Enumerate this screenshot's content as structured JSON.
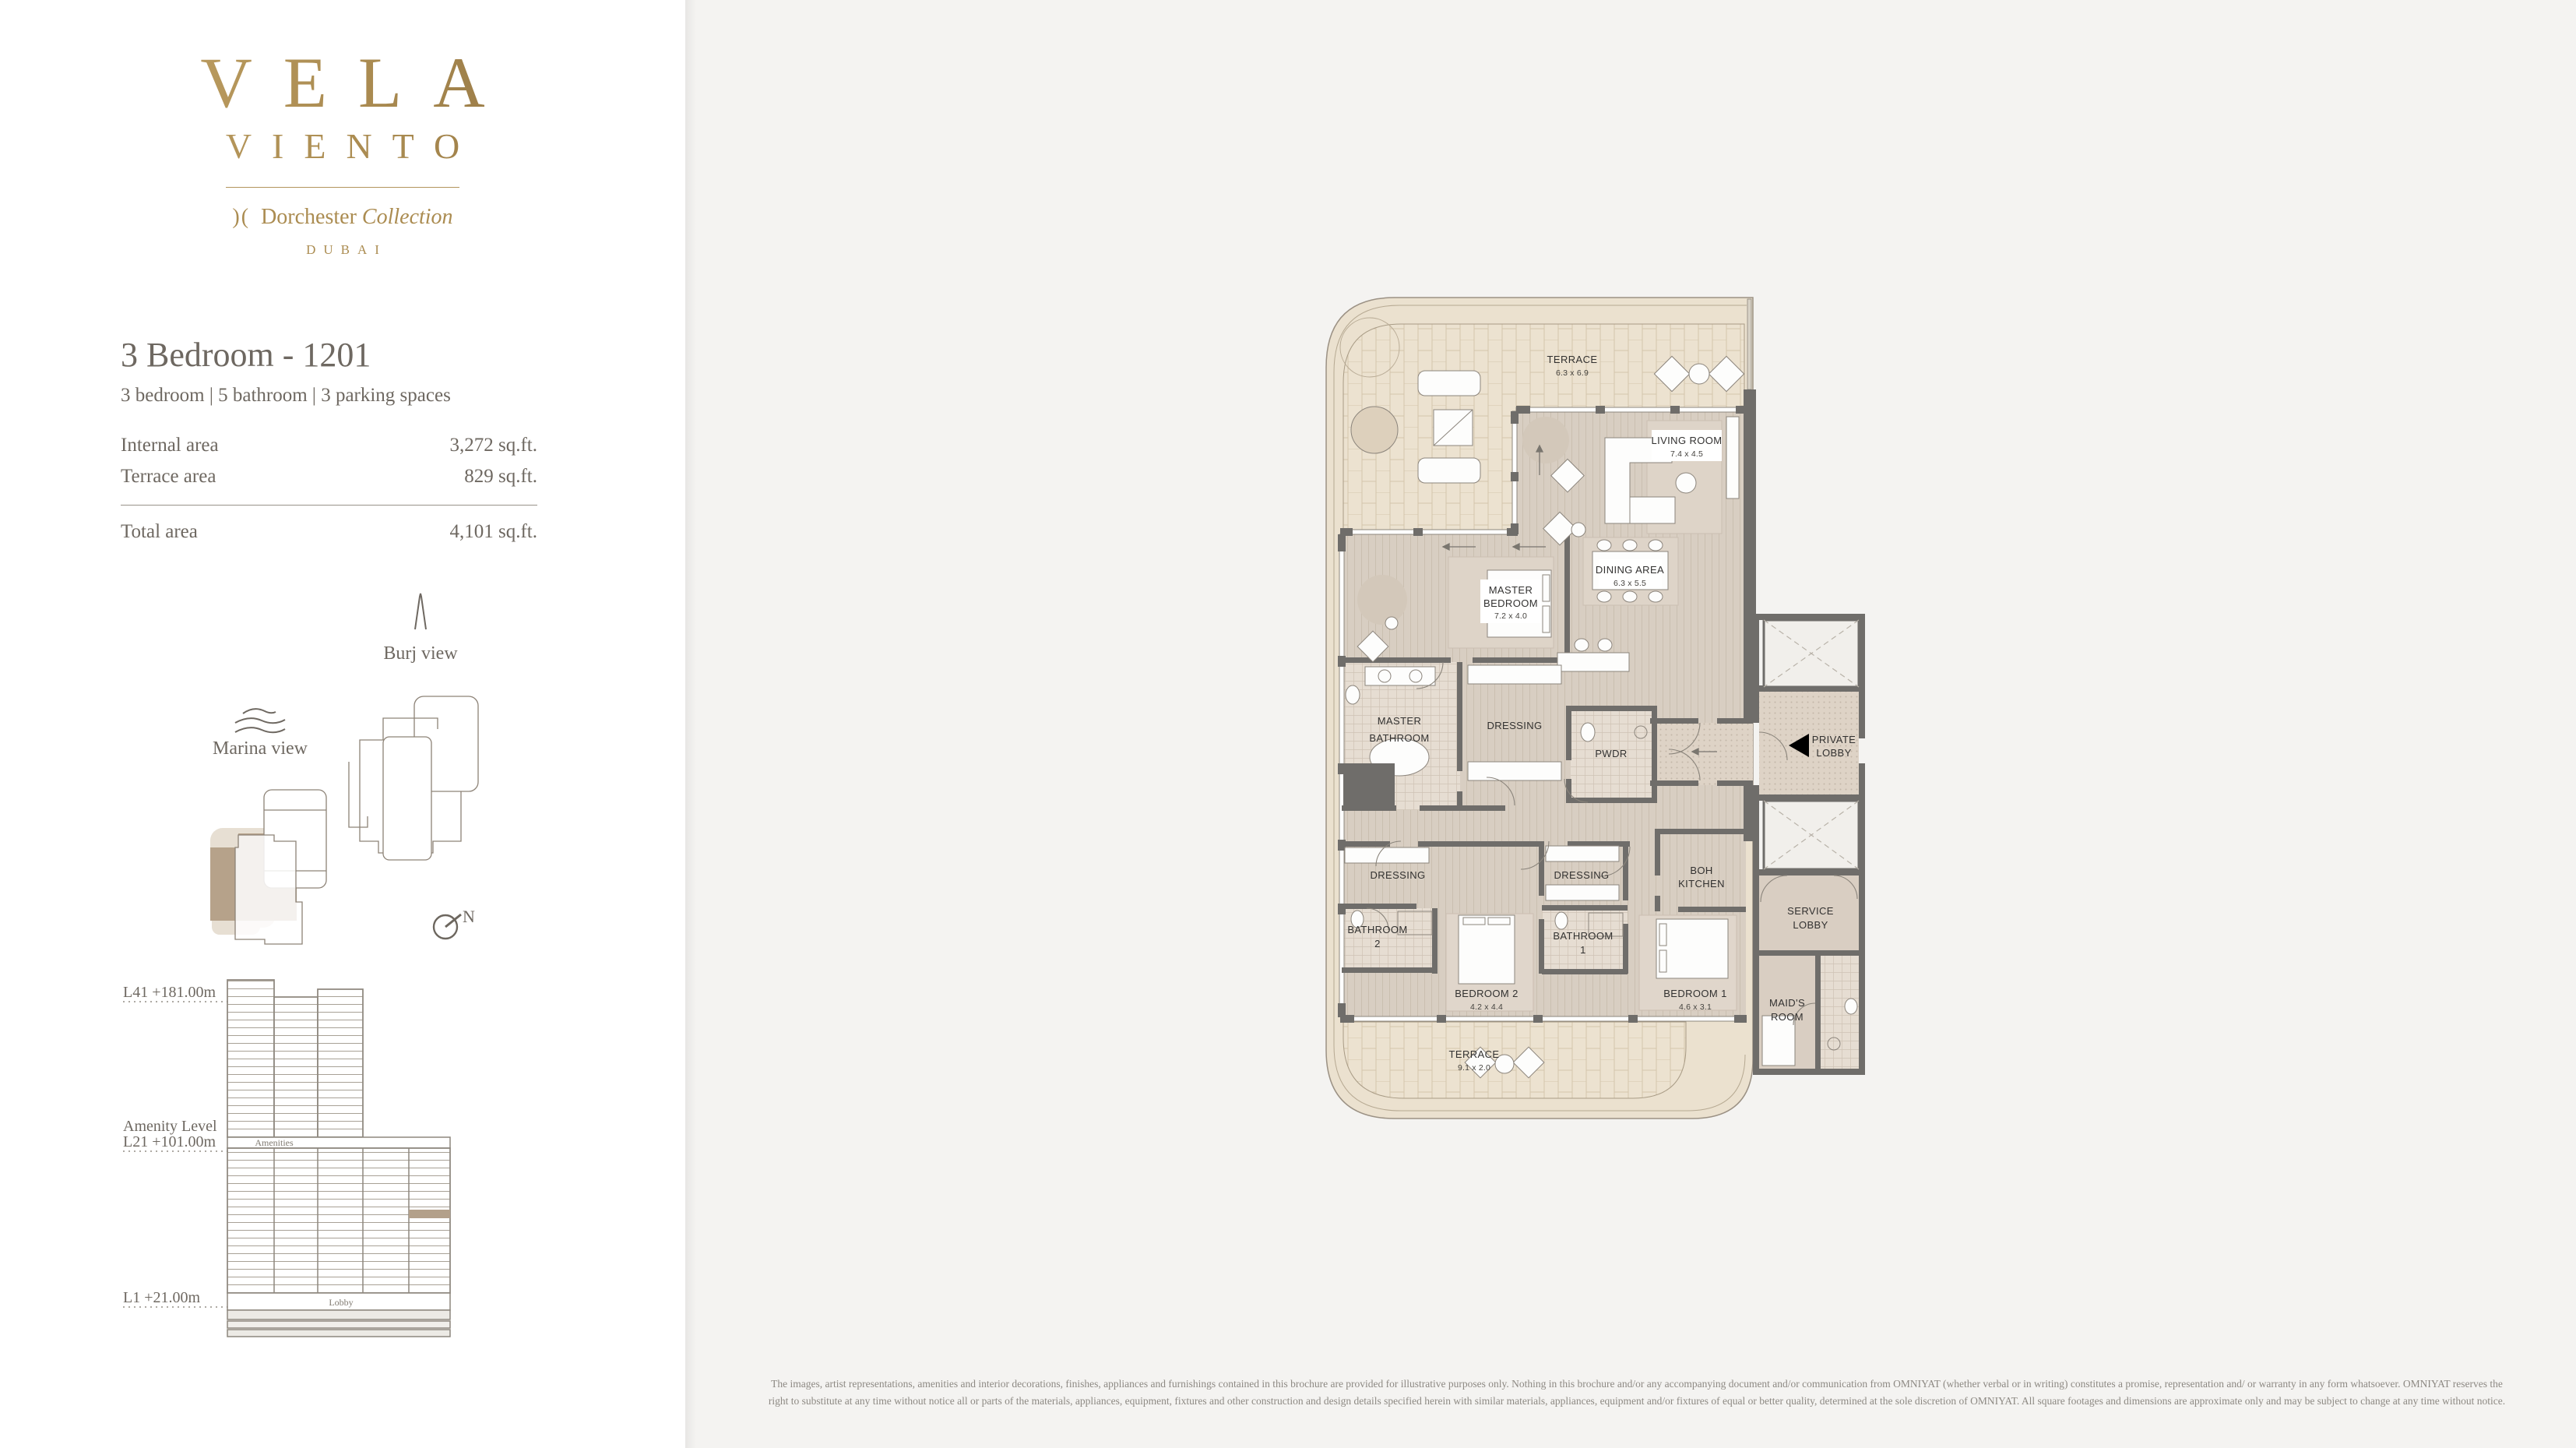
{
  "brand": {
    "name_line1": "VELA",
    "name_line2": "VIENTO",
    "collection_mark": ")(",
    "collection_name": "Dorchester",
    "collection_word": "Collection",
    "city": "DUBAI",
    "gold": "#a8894f"
  },
  "unit": {
    "title": "3 Bedroom - 1201",
    "subtitle": "3 bedroom | 5 bathroom | 3 parking spaces",
    "areas": [
      {
        "label": "Internal area",
        "value": "3,272 sq.ft."
      },
      {
        "label": "Terrace area",
        "value": "829 sq.ft."
      }
    ],
    "total": {
      "label": "Total area",
      "value": "4,101 sq.ft."
    }
  },
  "views": {
    "burj_label": "Burj view",
    "marina_label": "Marina view",
    "compass_n": "N",
    "highlight_color": "#b6a28a"
  },
  "elevation": {
    "levels": [
      {
        "label": "L41 +181.00m"
      },
      {
        "label": "Amenity Level"
      },
      {
        "label": "L21 +101.00m"
      },
      {
        "label": "L1 +21.00m"
      }
    ],
    "amenities_label": "Amenities",
    "lobby_label": "Lobby",
    "highlight_color": "#b3a08a"
  },
  "plan": {
    "wall_color": "#6f6d6a",
    "terrace_color": "#ece2d0",
    "floor_color": "#d8cec2",
    "rooms": [
      {
        "id": "terrace-top",
        "lines": [
          "TERRACE"
        ],
        "dims": "6.3 x 6.9"
      },
      {
        "id": "living-room",
        "lines": [
          "LIVING ROOM"
        ],
        "dims": "7.4 x 4.5"
      },
      {
        "id": "dining-area",
        "lines": [
          "DINING AREA"
        ],
        "dims": "6.3 x 5.5"
      },
      {
        "id": "master-bedroom",
        "lines": [
          "MASTER",
          "BEDROOM"
        ],
        "dims": "7.2 x 4.0"
      },
      {
        "id": "master-bathroom",
        "lines": [
          "MASTER",
          "BATHROOM"
        ],
        "dims": ""
      },
      {
        "id": "dressing-master",
        "lines": [
          "DRESSING"
        ],
        "dims": ""
      },
      {
        "id": "pwdr",
        "lines": [
          "PWDR"
        ],
        "dims": ""
      },
      {
        "id": "private-lobby",
        "lines": [
          "PRIVATE",
          "LOBBY"
        ],
        "dims": ""
      },
      {
        "id": "dressing-west",
        "lines": [
          "DRESSING"
        ],
        "dims": ""
      },
      {
        "id": "dressing-mid",
        "lines": [
          "DRESSING"
        ],
        "dims": ""
      },
      {
        "id": "boh-kitchen",
        "lines": [
          "BOH",
          "KITCHEN"
        ],
        "dims": ""
      },
      {
        "id": "bathroom-2",
        "lines": [
          "BATHROOM",
          "2"
        ],
        "dims": ""
      },
      {
        "id": "bathroom-1",
        "lines": [
          "BATHROOM",
          "1"
        ],
        "dims": ""
      },
      {
        "id": "bedroom-2",
        "lines": [
          "BEDROOM 2"
        ],
        "dims": "4.2 x 4.4"
      },
      {
        "id": "bedroom-1",
        "lines": [
          "BEDROOM 1"
        ],
        "dims": "4.6 x 3.1"
      },
      {
        "id": "service-lobby",
        "lines": [
          "SERVICE",
          "LOBBY"
        ],
        "dims": ""
      },
      {
        "id": "maids-room",
        "lines": [
          "MAID'S",
          "ROOM"
        ],
        "dims": ""
      },
      {
        "id": "terrace-bottom",
        "lines": [
          "TERRACE"
        ],
        "dims": "9.1 x 2.0"
      }
    ]
  },
  "disclaimer": "The images, artist representations, amenities and interior decorations, finishes, appliances and furnishings contained in this brochure are provided for illustrative purposes only. Nothing in this brochure and/or any accompanying document and/or communication from OMNIYAT (whether verbal or in writing) constitutes a promise, representation and/ or warranty in any form whatsoever. OMNIYAT reserves the right to substitute at any time without notice all or parts of the materials, appliances, equipment, fixtures and other construction and design details specified herein with similar materials, appliances, equipment and/or fixtures of equal or better quality, determined at the sole discretion of OMNIYAT. All square footages and dimensions are approximate only and may be subject to change at any time without notice."
}
